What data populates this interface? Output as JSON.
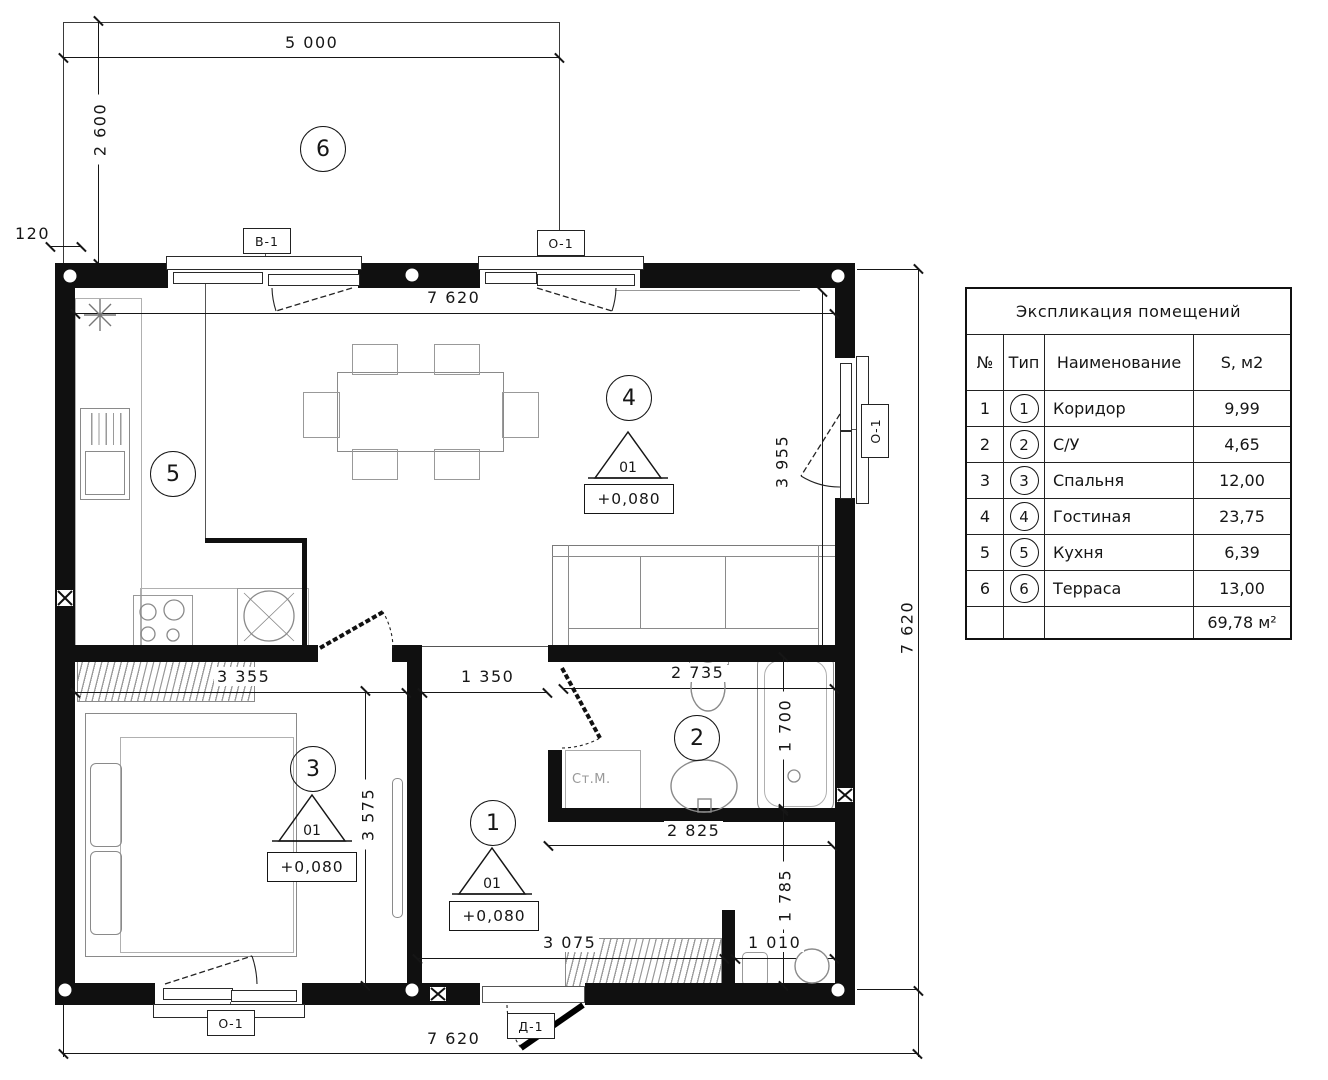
{
  "plan": {
    "rooms": {
      "terrace": "6",
      "kitchen": "5",
      "living": "4",
      "bedroom": "3",
      "bath": "2",
      "corridor": "1"
    },
    "dims": {
      "terrace_width": "5 000",
      "terrace_depth": "2 600",
      "wall_offset": "120",
      "top_inner": "7 620",
      "living_height": "3 955",
      "right_total": "7 620",
      "corridor_pass": "1 350",
      "bath_width": "2 735",
      "tub_length": "1 700",
      "bedroom_width": "3 355",
      "bedroom_height": "3 575",
      "bath_bottom": "2 825",
      "corr_height": "1 785",
      "corr_width": "3 075",
      "niche_width": "1 010",
      "bottom_total": "7 620"
    },
    "elevation": {
      "value": "+0,080",
      "mark": "01"
    },
    "tags": {
      "v1": "В-1",
      "o1": "О-1",
      "d1": "Д-1"
    },
    "labels": {
      "washer": "Ст.М."
    },
    "colors": {
      "ink": "#161616",
      "furniture": "#8a8a8a"
    }
  },
  "table": {
    "title": "Экспликация помещений",
    "headers": {
      "num": "№",
      "type": "Тип",
      "name": "Наименование",
      "area": "S, м2"
    },
    "rows": [
      {
        "num": "1",
        "type": "1",
        "name": "Коридор",
        "area": "9,99"
      },
      {
        "num": "2",
        "type": "2",
        "name": "С/У",
        "area": "4,65"
      },
      {
        "num": "3",
        "type": "3",
        "name": "Спальня",
        "area": "12,00"
      },
      {
        "num": "4",
        "type": "4",
        "name": "Гостиная",
        "area": "23,75"
      },
      {
        "num": "5",
        "type": "5",
        "name": "Кухня",
        "area": "6,39"
      },
      {
        "num": "6",
        "type": "6",
        "name": "Терраса",
        "area": "13,00"
      }
    ],
    "total": "69,78 м²"
  }
}
